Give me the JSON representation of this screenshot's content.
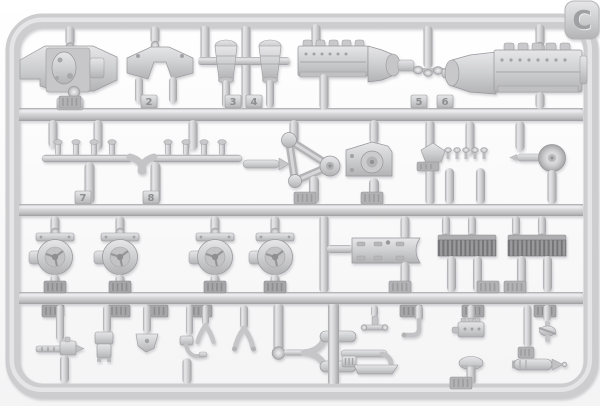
{
  "photo": {
    "subject": "Injection-molded light-gray plastic model kit sprue with engine, drivetrain and accessory parts",
    "sprue_label": "C",
    "plastic_color": "#d2d2d4",
    "plastic_highlight": "#ebebed",
    "plastic_shadow": "#a5a5a8",
    "background_color": "#ffffff",
    "part_number_tags_visible": [
      "2",
      "3",
      "4",
      "5",
      "6",
      "7",
      "8"
    ]
  },
  "tags": {
    "t2": "2",
    "t3": "3",
    "t4": "4",
    "t5": "5",
    "t6": "6",
    "t7": "7",
    "t8": "8"
  }
}
